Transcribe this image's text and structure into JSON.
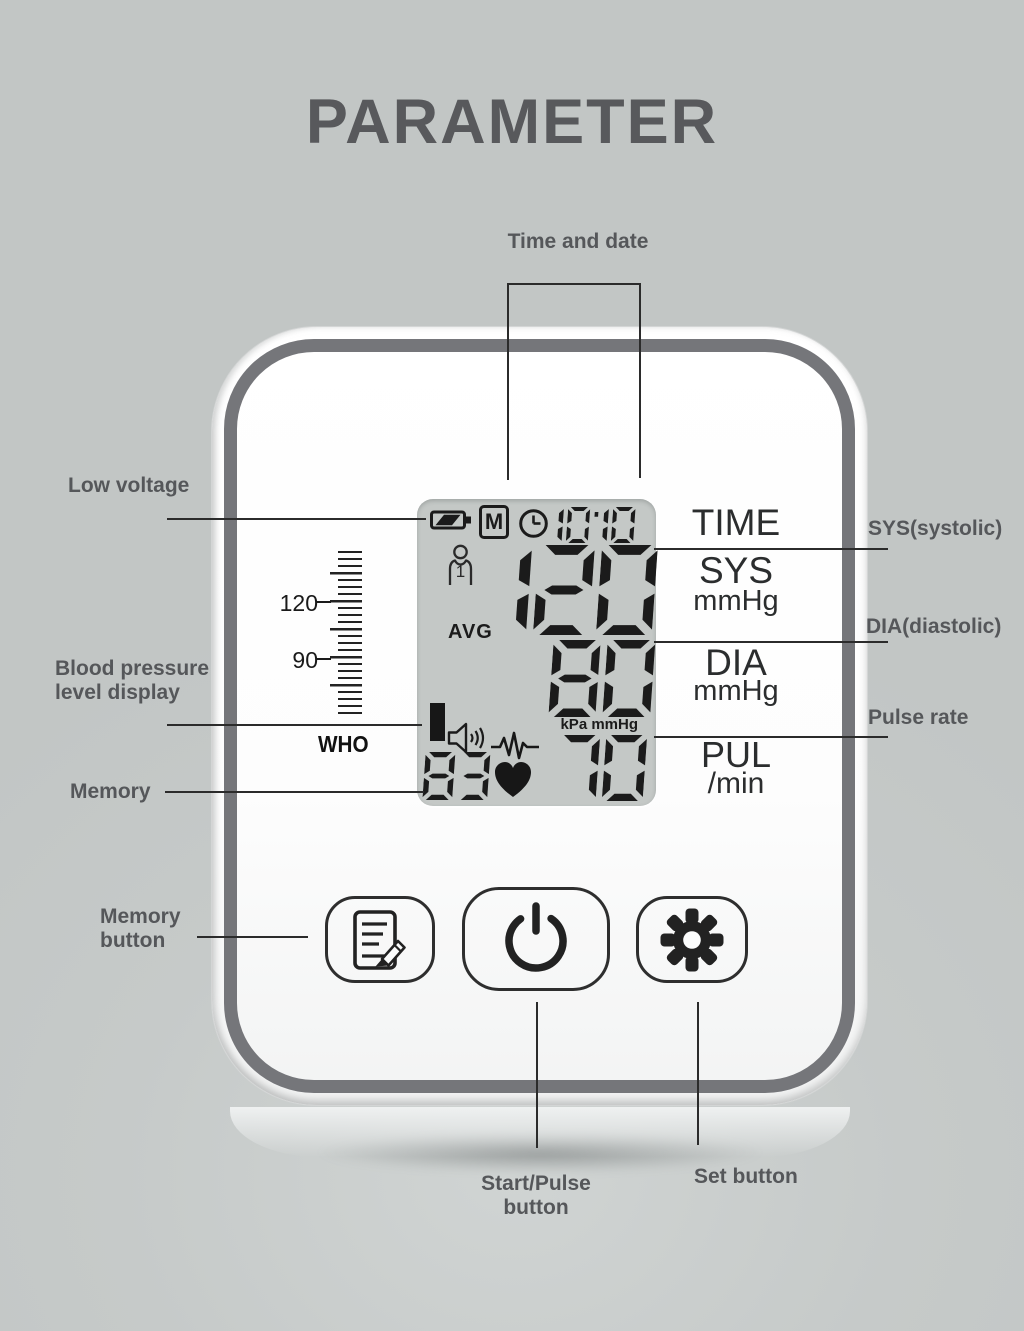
{
  "title": "PARAMETER",
  "callouts": {
    "time_and_date": "Time and date",
    "low_voltage": "Low voltage",
    "bp_level_line1": "Blood pressure",
    "bp_level_line2": "level display",
    "memory": "Memory",
    "memory_button_line1": "Memory",
    "memory_button_line2": "button",
    "sys": "SYS(systolic)",
    "dia": "DIA(diastolic)",
    "pulse_rate": "Pulse rate",
    "set_button": "Set button",
    "start_pulse_line1": "Start/Pulse",
    "start_pulse_line2": "button"
  },
  "display": {
    "memory_flag": "M",
    "time": "10:10",
    "user_number": "1",
    "avg_label": "AVG",
    "sys_value": "120",
    "dia_value": "80",
    "pulse_value": "70",
    "memory_count": "83",
    "unit_label": "kPa mmHg"
  },
  "scale": {
    "tick_label_upper": "120",
    "tick_label_lower": "90",
    "who_label": "WHO"
  },
  "device_labels": {
    "time": "TIME",
    "sys": "SYS",
    "sys_unit": "mmHg",
    "dia": "DIA",
    "dia_unit": "mmHg",
    "pul": "PUL",
    "pul_unit": "/min"
  },
  "icons": {
    "battery": "low-battery-icon",
    "memory_flag_box": "memory-flag-icon",
    "clock": "clock-icon",
    "user": "user-icon",
    "who_level": "who-level-bar",
    "speaker": "speaker-icon",
    "ecg": "ecg-waveform-icon",
    "heart": "heart-icon",
    "memory_button": "document-pencil-icon",
    "start_button": "power-icon",
    "set_button": "gear-icon"
  },
  "colors": {
    "background": "#c6cac9",
    "label_text": "#55575a",
    "title_text": "#58595c",
    "line": "#2b2b2b",
    "lcd_panel": "#c4c8c6",
    "lcd_segment": "#1b1b1b",
    "device_band": "#75767a",
    "device_face": "#fbfcfc",
    "print_text": "#2b2d2e"
  }
}
